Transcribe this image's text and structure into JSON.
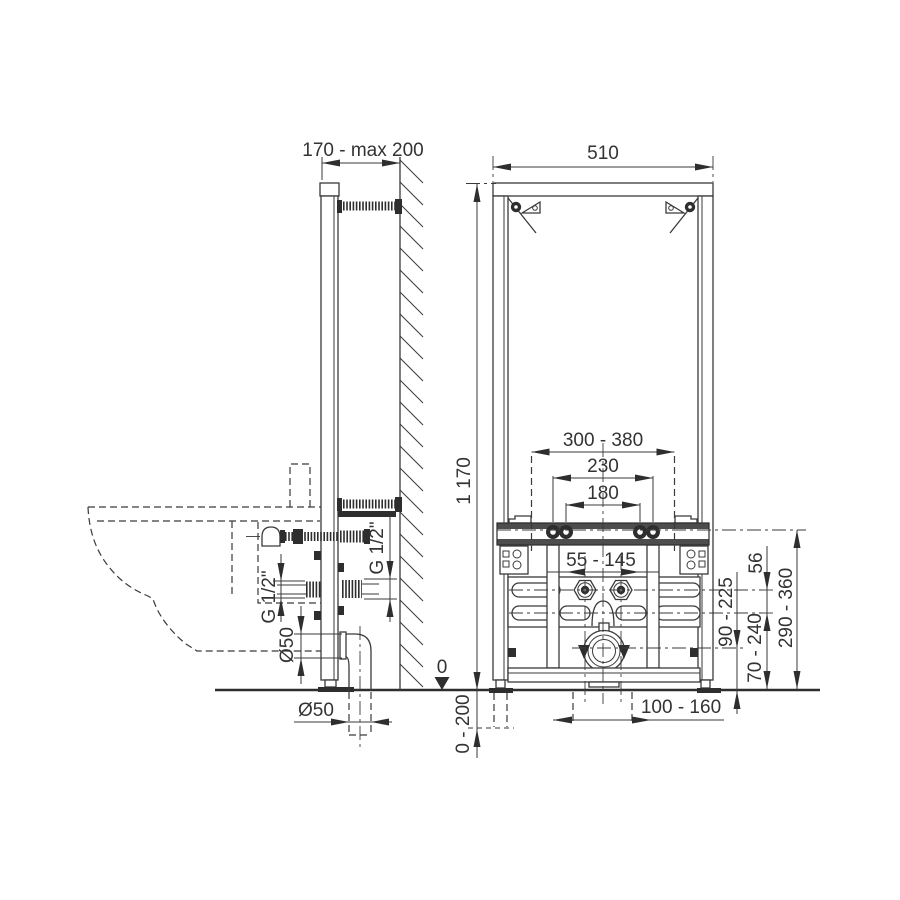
{
  "colors": {
    "line": "#3a3a3a",
    "fill_dark": "#2e2e2e",
    "background": "#ffffff"
  },
  "side_view": {
    "dims": {
      "wall_distance": "170 - max 200",
      "water_thread_front": "G 1/2\"",
      "water_thread_rear": "G 1/2\"",
      "waste_pipe_diameter": "Ø50",
      "waste_outlet_diameter": "Ø50",
      "floor_level": "0"
    }
  },
  "front_view": {
    "dims": {
      "frame_width": "510",
      "frame_height": "1 170",
      "fixing_range": "300 - 380",
      "stud_spacing_outer": "230",
      "stud_spacing_inner": "180",
      "water_conn_range": "55 - 145",
      "water_conn_offset": "56",
      "stud_height_range": "290 - 360",
      "waste_height_range": "90 - 225",
      "bracket_height_range": "70 - 240",
      "waste_lateral_range": "100 - 160",
      "leg_adjustment": "0 - 200"
    }
  }
}
